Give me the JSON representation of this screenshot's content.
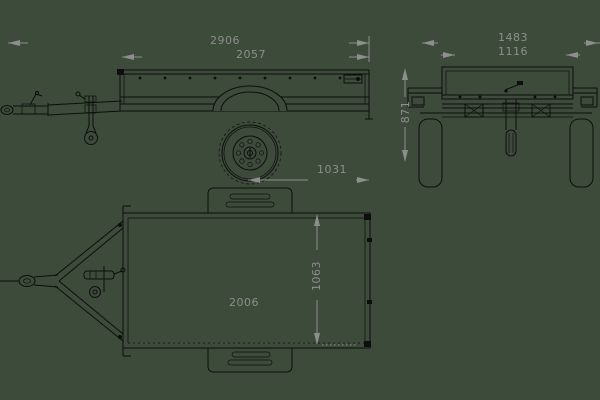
{
  "drawing_subject": "box-trailer three-view dimensional drawing",
  "colors": {
    "background": "#3c4b3a",
    "line_color": "#0e0e0e",
    "dimension_color": "#8e8e8e"
  },
  "views": {
    "side": {
      "overall_length": "2906",
      "box_length": "2057",
      "axle_to_rear": "1031"
    },
    "rear": {
      "overall_width": "1483",
      "inner_width": "1116",
      "overall_height": "871"
    },
    "top": {
      "inner_length": "2006",
      "inner_width": "1063"
    }
  }
}
